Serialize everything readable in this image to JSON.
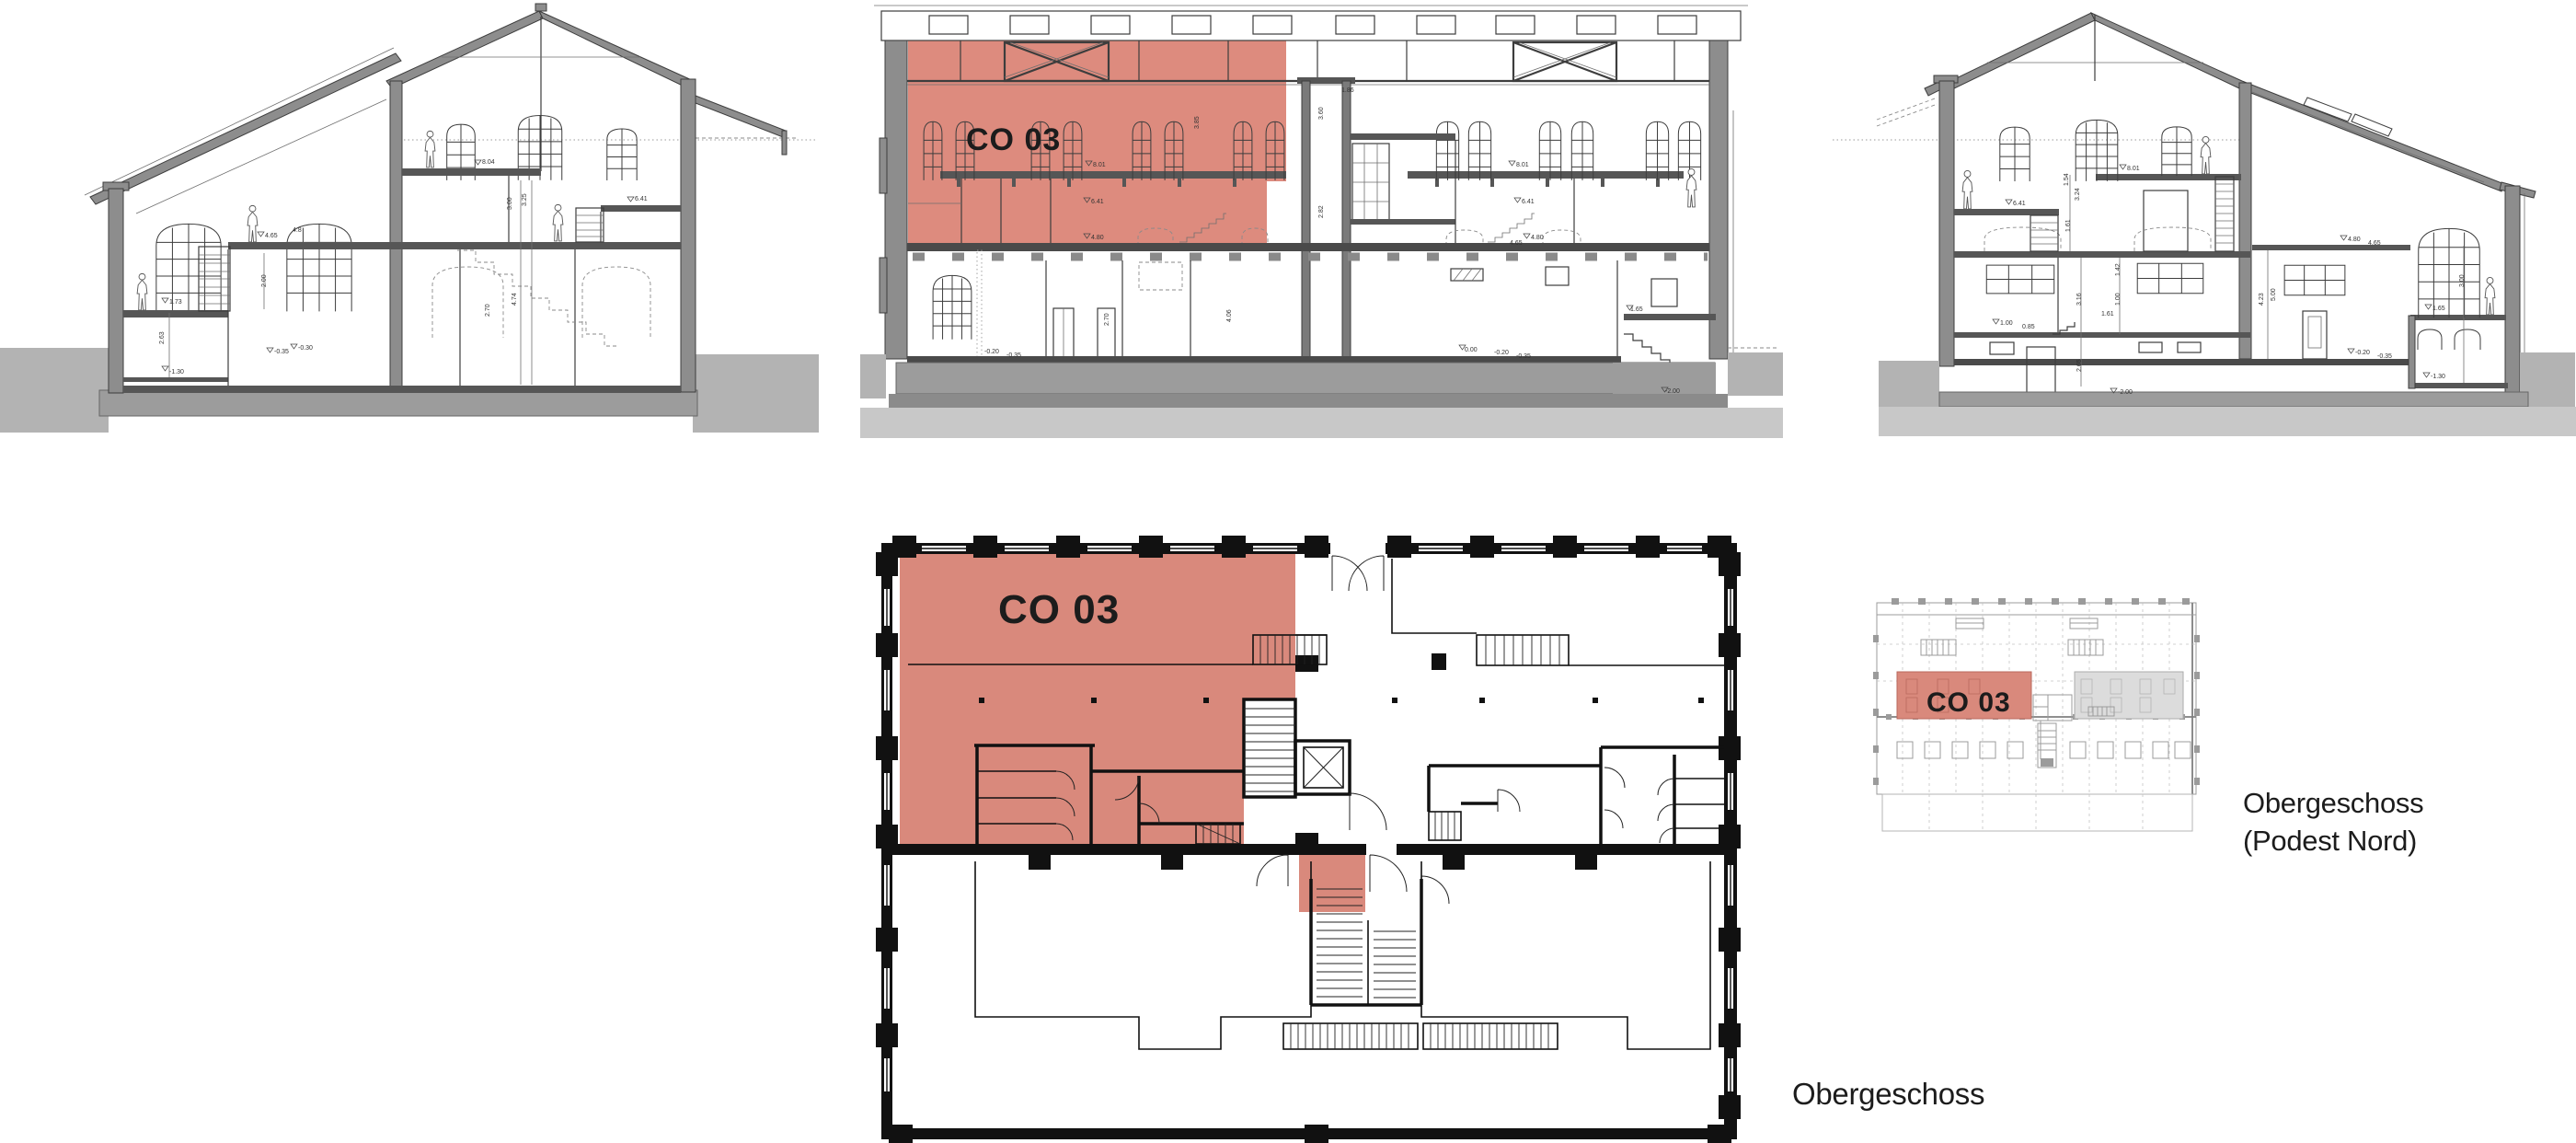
{
  "labels": {
    "unit_section": "CO 03",
    "unit_plan": "CO 03",
    "unit_plan_small": "CO 03",
    "caption_plan": "Obergeschoss",
    "caption_podest_line1": "Obergeschoss",
    "caption_podest_line2": "(Podest Nord)"
  },
  "colors": {
    "highlight_red": "#dd8b7e",
    "highlight_red_plan": "#d9897c",
    "gray_area": "#dcdcdc",
    "ground_gray": "#b3b3b3",
    "foundation_gray": "#9c9c9c",
    "wall_gray": "#8d8d8d",
    "light_ground": "#c8c8c8",
    "line_color": "#3d3d3d",
    "plan_line_black": "#111111",
    "text_color": "#1c1c1c"
  },
  "dims": {
    "west": [
      "8.04",
      "6.41",
      "4.65",
      "4.8",
      "1.73",
      "-1.30",
      "-0.35",
      "-0.30",
      "2.00",
      "2.63",
      "2.70",
      "4.74",
      "3.00",
      "3.25"
    ],
    "long": [
      "8.01",
      "8.01",
      "6.41",
      "6.41",
      "4.80",
      "4.80",
      "4.65",
      "3.85",
      "3.60",
      "2.82",
      "1.86",
      "0.00",
      "-0.20",
      "-0.35",
      "-0.20",
      "-0.35",
      "1.65",
      "-2.00",
      "2.70",
      "4.06"
    ],
    "east": [
      "8.01",
      "6.41",
      "4.80",
      "4.65",
      "1.54",
      "3.24",
      "1.61",
      "3.16",
      "1.42",
      "1.00",
      "0.85",
      "1.61",
      "2.65",
      "-2.00",
      "4.23",
      "5.00",
      "1.65",
      "-0.20",
      "-0.35",
      "-1.30",
      "3.00",
      "1.00"
    ]
  }
}
